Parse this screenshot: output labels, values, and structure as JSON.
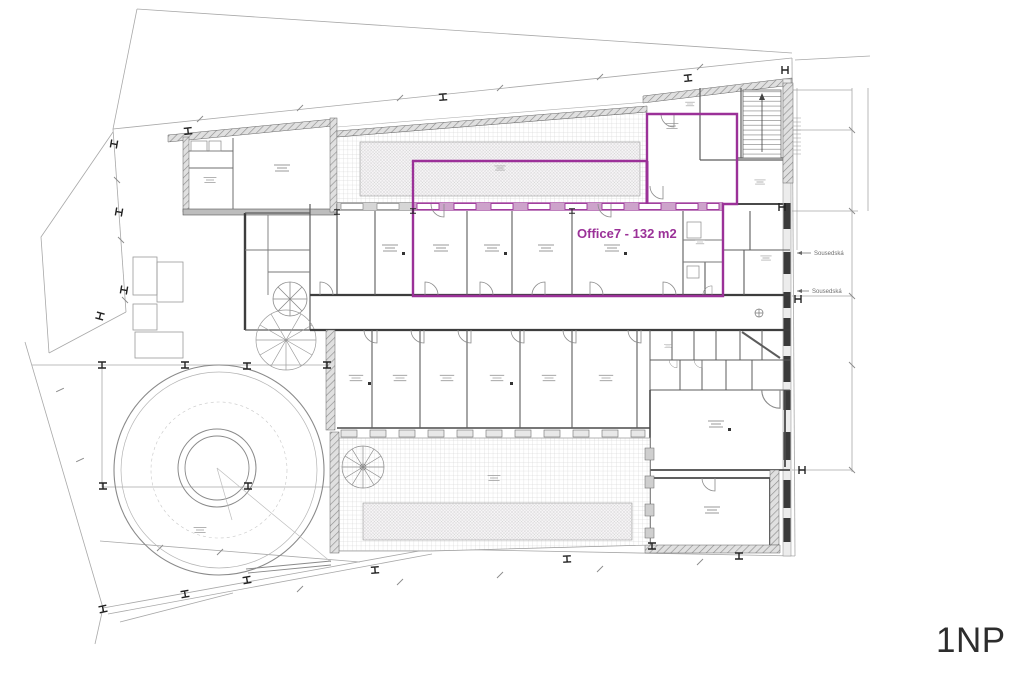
{
  "plan": {
    "floor_label": "1NP",
    "office": {
      "label": "Office7 - 132 m2",
      "name": "Office7",
      "area_m2": 132,
      "highlight_color": "#9b3198"
    },
    "neighbor_notes": [
      {
        "text": "Sousedská"
      },
      {
        "text": "Sousedská"
      }
    ],
    "colors": {
      "background": "#ffffff",
      "wall_dark": "#3d3d3d",
      "wall_gray": "#6f6f6f",
      "thin_line": "#9e9e9e",
      "hatch_fill": "#e0e0e0",
      "highlight": "#9b3198",
      "floor_label_color": "#2d2d2d"
    }
  }
}
